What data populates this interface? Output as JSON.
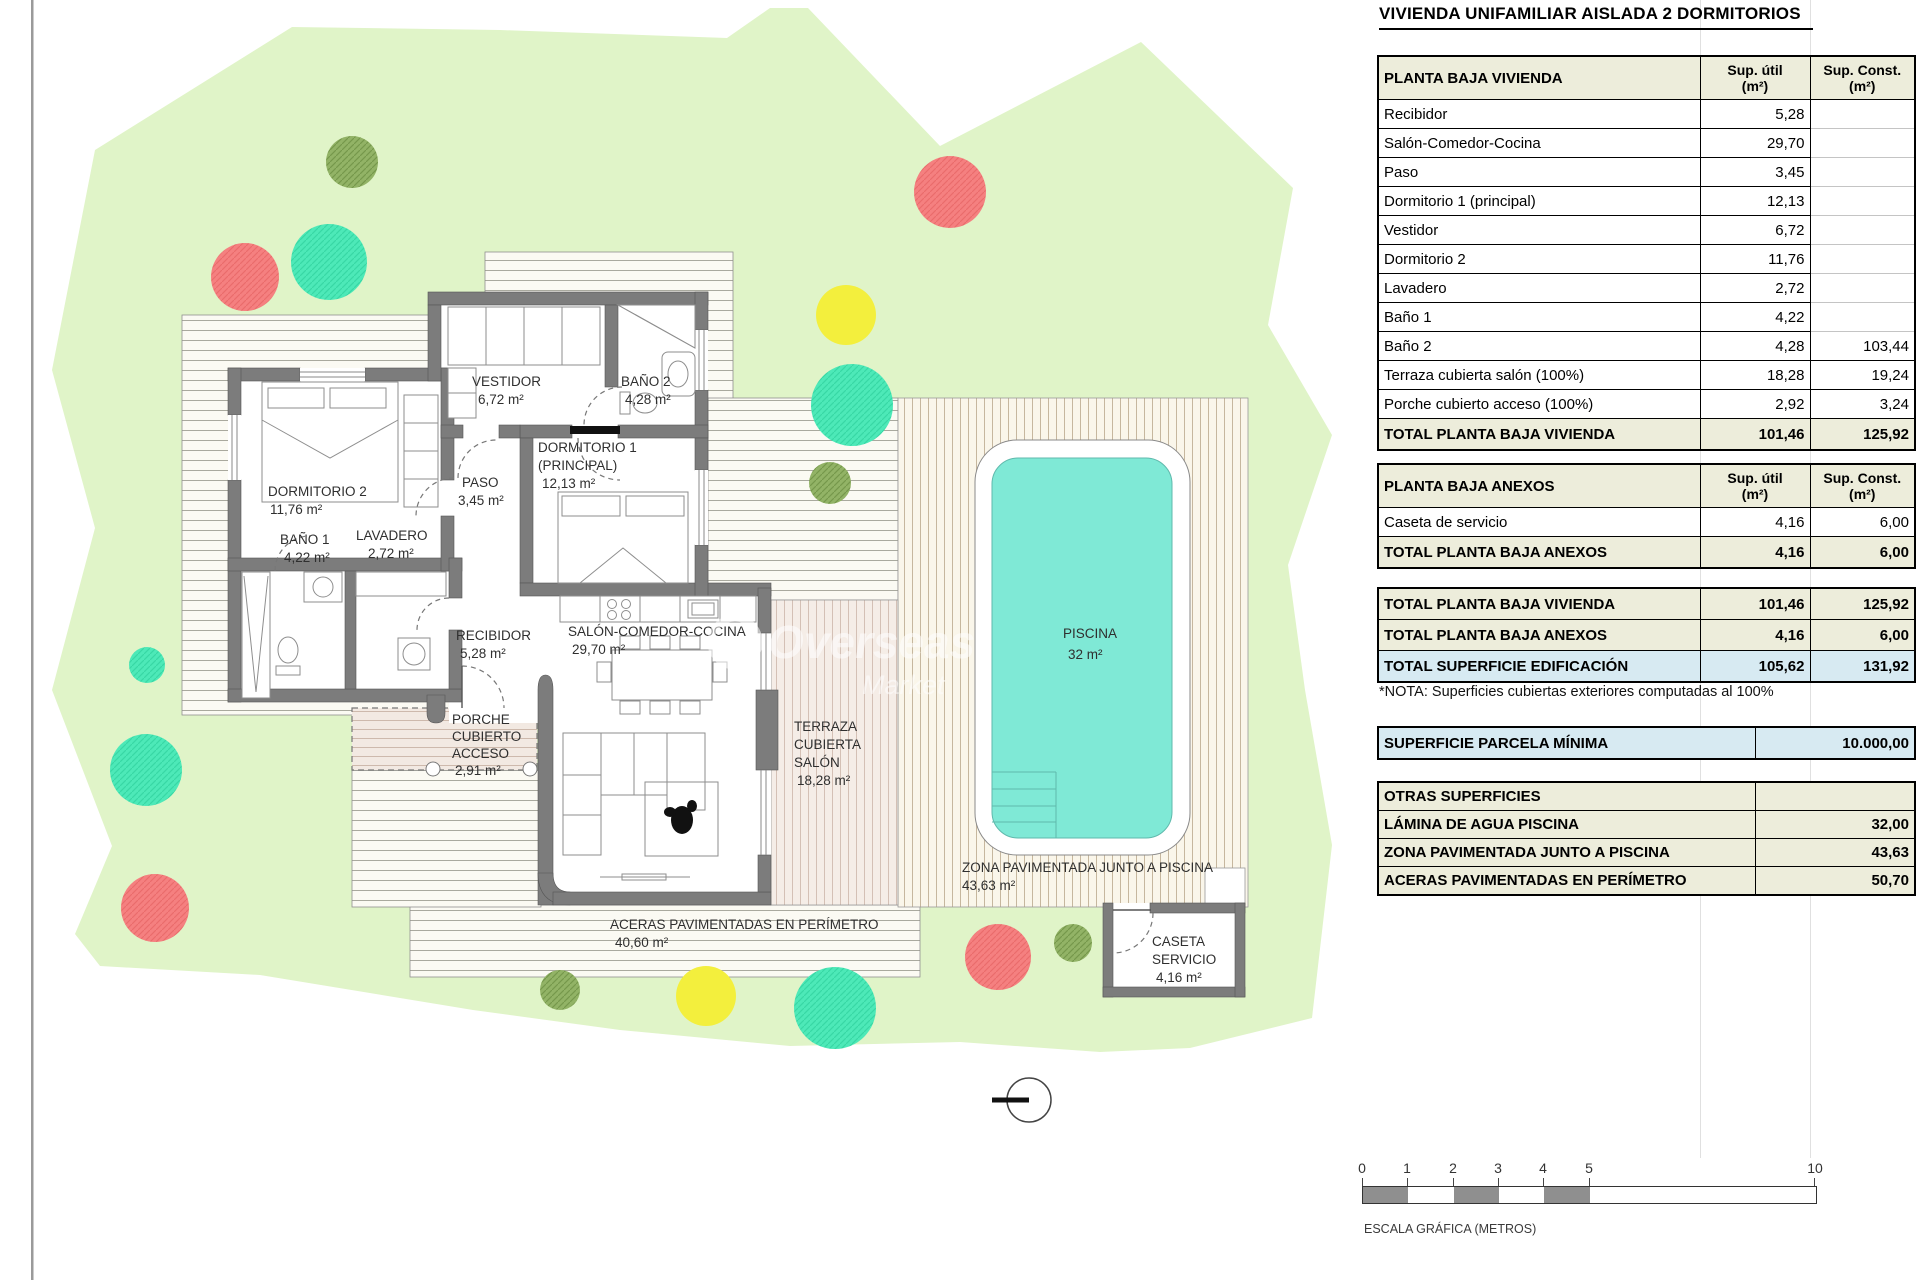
{
  "title": "VIVIENDA UNIFAMILIAR AISLADA 2 DORMITORIOS",
  "colors": {
    "parcel_green": "#E0F4C8",
    "pool_cyan": "#7FE9D6",
    "tree_red": "#F58080",
    "tree_teal": "#4DE9B8",
    "tree_yellow": "#F3EF3D",
    "tree_olive": "#92B366",
    "table_beige": "#EDEDDB",
    "table_blue": "#D7EAF2",
    "wall_gray": "#7C7C7C"
  },
  "cols": {
    "util1": "Sup. útil",
    "util2": "(m²)",
    "const1": "Sup. Const.",
    "const2": "(m²)"
  },
  "t1": {
    "title": "PLANTA BAJA VIVIENDA",
    "rows": [
      {
        "label": "Recibidor",
        "util": "5,28",
        "cons": ""
      },
      {
        "label": "Salón-Comedor-Cocina",
        "util": "29,70",
        "cons": ""
      },
      {
        "label": "Paso",
        "util": "3,45",
        "cons": ""
      },
      {
        "label": "Dormitorio 1 (principal)",
        "util": "12,13",
        "cons": ""
      },
      {
        "label": "Vestidor",
        "util": "6,72",
        "cons": ""
      },
      {
        "label": "Dormitorio 2",
        "util": "11,76",
        "cons": ""
      },
      {
        "label": "Lavadero",
        "util": "2,72",
        "cons": ""
      },
      {
        "label": "Baño 1",
        "util": "4,22",
        "cons": ""
      },
      {
        "label": "Baño 2",
        "util": "4,28",
        "cons": "103,44"
      },
      {
        "label": "Terraza cubierta salón (100%)",
        "util": "18,28",
        "cons": "19,24"
      },
      {
        "label": "Porche cubierto acceso (100%)",
        "util": "2,92",
        "cons": "3,24"
      }
    ],
    "total": {
      "label": "TOTAL PLANTA BAJA VIVIENDA",
      "util": "101,46",
      "cons": "125,92"
    }
  },
  "t2": {
    "title": "PLANTA BAJA ANEXOS",
    "rows": [
      {
        "label": "Caseta de servicio",
        "util": "4,16",
        "cons": "6,00"
      }
    ],
    "total": {
      "label": "TOTAL PLANTA BAJA ANEXOS",
      "util": "4,16",
      "cons": "6,00"
    }
  },
  "t3": {
    "rows": [
      {
        "label": "TOTAL PLANTA BAJA VIVIENDA",
        "util": "101,46",
        "cons": "125,92"
      },
      {
        "label": "TOTAL PLANTA BAJA ANEXOS",
        "util": "4,16",
        "cons": "6,00"
      },
      {
        "label": "TOTAL SUPERFICIE EDIFICACIÓN",
        "util": "105,62",
        "cons": "131,92"
      }
    ]
  },
  "nota": "*NOTA: Superficies cubiertas exteriores computadas al 100%",
  "t4": {
    "label": "SUPERFICIE PARCELA MÍNIMA",
    "value": "10.000,00"
  },
  "t5": {
    "title": "OTRAS SUPERFICIES",
    "rows": [
      {
        "label": "LÁMINA DE AGUA PISCINA",
        "value": "32,00"
      },
      {
        "label": "ZONA PAVIMENTADA JUNTO A PISCINA",
        "value": "43,63"
      },
      {
        "label": "ACERAS PAVIMENTADAS EN PERÍMETRO",
        "value": "50,70"
      }
    ]
  },
  "scalebar": {
    "ticks": [
      "0",
      "1",
      "2",
      "3",
      "4",
      "5",
      "10"
    ],
    "caption": "ESCALA GRÁFICA (METROS)"
  },
  "watermark": {
    "l1": "Overseas",
    "l2": "Market"
  },
  "plan": {
    "rooms": {
      "dorm2": {
        "l1": "DORMITORIO 2",
        "l2": "11,76 m²"
      },
      "bano1": {
        "l1": "BAÑO 1",
        "l2": "4,22 m²"
      },
      "lavadero": {
        "l1": "LAVADERO",
        "l2": "2,72 m²"
      },
      "paso": {
        "l1": "PASO",
        "l2": "3,45 m²"
      },
      "vestidor": {
        "l1": "VESTIDOR",
        "l2": "6,72 m²"
      },
      "bano2": {
        "l1": "BAÑO 2",
        "l2": "4,28 m²"
      },
      "dorm1": {
        "l1": "DORMITORIO 1",
        "l2": "(PRINCIPAL)",
        "l3": "12,13 m²"
      },
      "recibidor": {
        "l1": "RECIBIDOR",
        "l2": "5,28 m²"
      },
      "salon": {
        "l1": "SALÓN-COMEDOR-COCINA",
        "l2": "29,70 m²"
      },
      "porche": {
        "l1": "PORCHE",
        "l2": "CUBIERTO",
        "l3": "ACCESO",
        "l4": "2,91 m²"
      },
      "terraza": {
        "l1": "TERRAZA",
        "l2": "CUBIERTA",
        "l3": "SALÓN",
        "l4": "18,28 m²"
      },
      "aceras": {
        "l1": "ACERAS PAVIMENTADAS EN PERÍMETRO",
        "l2": "40,60 m²"
      },
      "zona": {
        "l1": "ZONA PAVIMENTADA JUNTO A PISCINA",
        "l2": "43,63 m²"
      },
      "piscina": {
        "l1": "PISCINA",
        "l2": "32 m²"
      },
      "caseta": {
        "l1": "CASETA",
        "l2": "SERVICIO",
        "l3": "4,16 m²"
      }
    }
  }
}
